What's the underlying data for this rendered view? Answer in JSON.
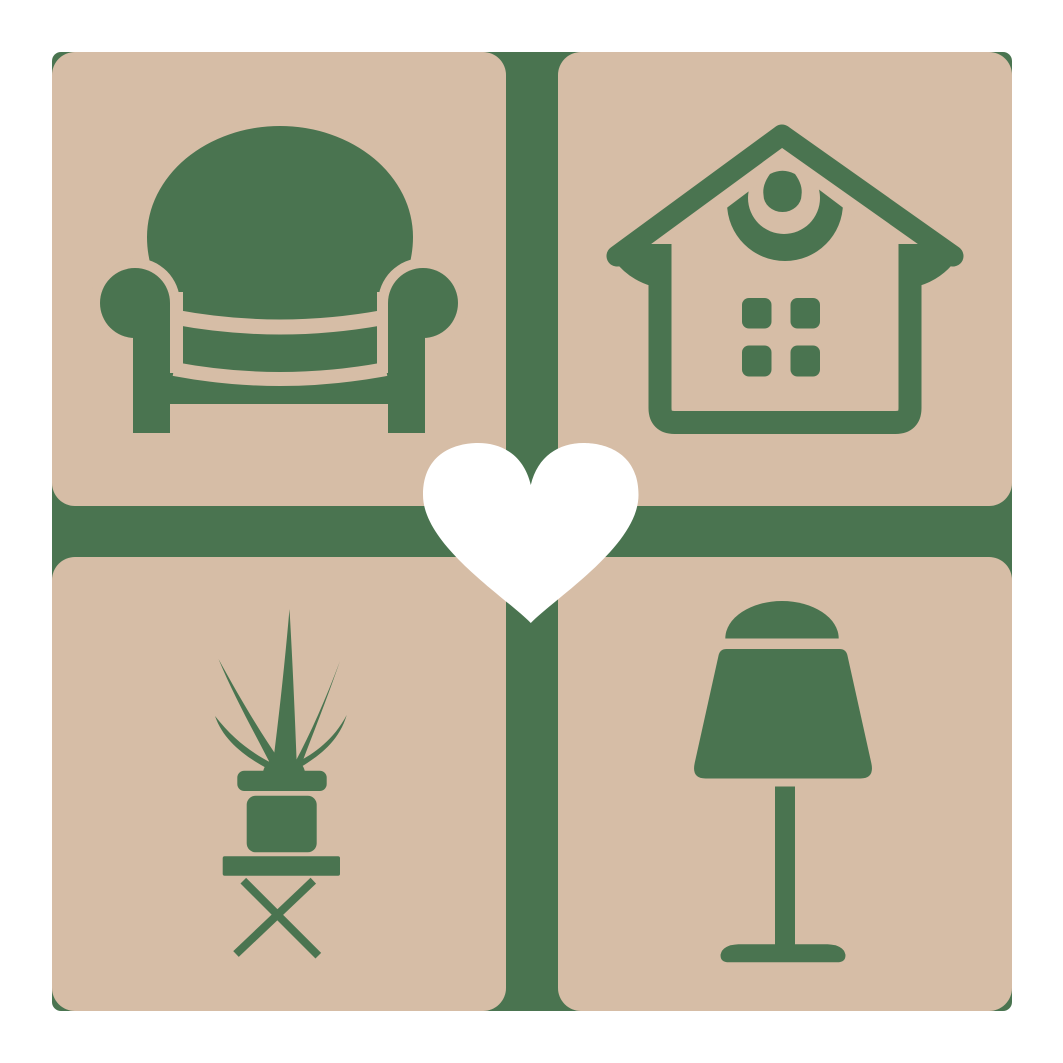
{
  "meta": {
    "kind": "logo-graphic",
    "description": "Square home-and-furniture logo: four tan rounded tiles on a green cross grid, each tile bearing a green furniture icon, joined by a white heart at the center"
  },
  "colors": {
    "page_background": "#ffffff",
    "grid_green": "#4a7450",
    "tile_tan": "#d6bda6",
    "icon_green": "#4a7450",
    "heart_white": "#ffffff"
  },
  "tiles": [
    {
      "position": "top-left",
      "icon": "armchair-icon",
      "label": "armchair"
    },
    {
      "position": "top-right",
      "icon": "house-icon",
      "label": "house"
    },
    {
      "position": "bottom-left",
      "icon": "potted-plant-icon",
      "label": "potted plant on stool"
    },
    {
      "position": "bottom-right",
      "icon": "table-lamp-icon",
      "label": "table lamp"
    }
  ],
  "center": {
    "icon": "heart-icon",
    "label": "heart"
  }
}
